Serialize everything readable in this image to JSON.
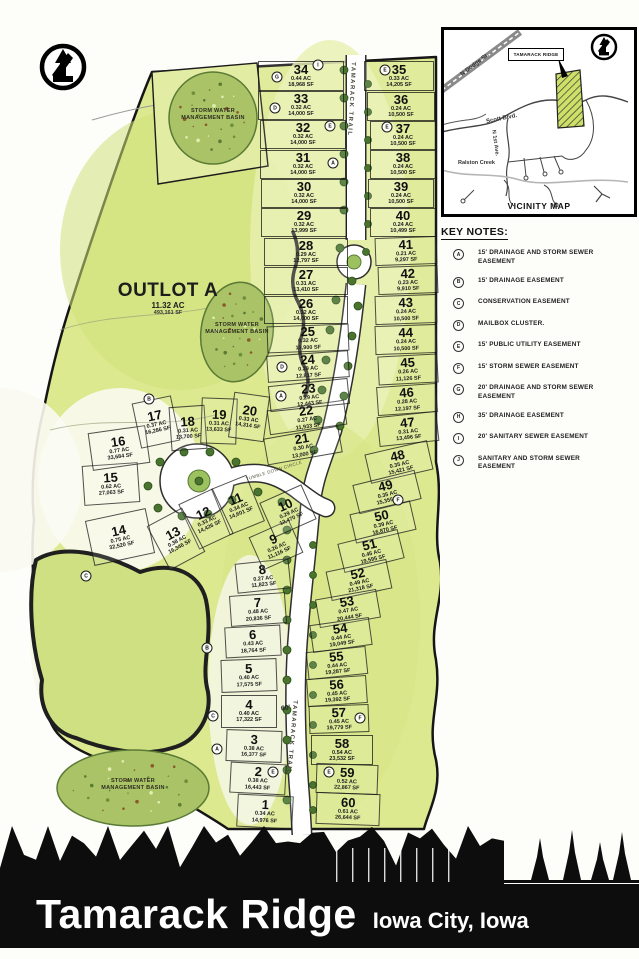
{
  "banner": {
    "title": "Tamarack Ridge",
    "subtitle": "Iowa City, Iowa"
  },
  "north_arrow": {
    "letter": "N"
  },
  "vicinity": {
    "caption": "VICINITY MAP",
    "site_label": "TAMARACK RIDGE",
    "roads": {
      "n_dodge": "N Dodge St.",
      "scott": "Scott Blvd.",
      "n_first": "N 1st Ave.",
      "creek": "Ralston Creek"
    }
  },
  "key_notes": {
    "title": "KEY NOTES:",
    "items": [
      {
        "key": "A",
        "text": "15' DRAINAGE AND STORM SEWER EASEMENT"
      },
      {
        "key": "B",
        "text": "15' DRAINAGE EASEMENT"
      },
      {
        "key": "C",
        "text": "CONSERVATION EASEMENT"
      },
      {
        "key": "D",
        "text": "MAILBOX CLUSTER."
      },
      {
        "key": "E",
        "text": "15' PUBLIC UTILITY EASEMENT"
      },
      {
        "key": "F",
        "text": "15' STORM SEWER EASEMENT"
      },
      {
        "key": "G",
        "text": "20' DRAINAGE AND STORM SEWER EASEMENT"
      },
      {
        "key": "H",
        "text": "35' DRAINAGE EASEMENT"
      },
      {
        "key": "I",
        "text": "20' SANITARY SEWER EASEMENT"
      },
      {
        "key": "J",
        "text": "SANITARY AND STORM SEWER EASEMENT"
      }
    ]
  },
  "plat": {
    "outlot": {
      "name": "OUTLOT A",
      "acres": "11.32 AC",
      "sqft": "493,161 SF"
    },
    "basin_label": "STORM WATER MANAGEMENT BASIN",
    "road_labels": {
      "trail": "TAMARACK TRAIL",
      "circle": "TUMBLE DOWN CIRCLE",
      "width": "60'"
    },
    "markers": [
      {
        "k": "I",
        "x": 318,
        "y": 65
      },
      {
        "k": "G",
        "x": 277,
        "y": 77
      },
      {
        "k": "D",
        "x": 275,
        "y": 108
      },
      {
        "k": "E",
        "x": 330,
        "y": 126
      },
      {
        "k": "E",
        "x": 385,
        "y": 70
      },
      {
        "k": "E",
        "x": 387,
        "y": 127
      },
      {
        "k": "A",
        "x": 333,
        "y": 163
      },
      {
        "k": "A",
        "x": 281,
        "y": 396
      },
      {
        "k": "D",
        "x": 282,
        "y": 367
      },
      {
        "k": "F",
        "x": 398,
        "y": 500
      },
      {
        "k": "F",
        "x": 360,
        "y": 718
      },
      {
        "k": "E",
        "x": 273,
        "y": 772
      },
      {
        "k": "E",
        "x": 329,
        "y": 772
      },
      {
        "k": "C",
        "x": 213,
        "y": 716
      },
      {
        "k": "A",
        "x": 217,
        "y": 749
      },
      {
        "k": "B",
        "x": 207,
        "y": 648
      },
      {
        "k": "C",
        "x": 86,
        "y": 576
      },
      {
        "k": "B",
        "x": 149,
        "y": 399
      }
    ],
    "lots": [
      {
        "n": "1",
        "ac": "0.34 AC",
        "sf": "14,976 SF",
        "x": 265,
        "y": 811,
        "w": 56,
        "h": 33,
        "r": 3
      },
      {
        "n": "2",
        "ac": "0.38 AC",
        "sf": "16,443 SF",
        "x": 258,
        "y": 778,
        "w": 56,
        "h": 31,
        "r": 3
      },
      {
        "n": "3",
        "ac": "0.38 AC",
        "sf": "16,377 SF",
        "x": 254,
        "y": 746,
        "w": 56,
        "h": 32,
        "r": 2
      },
      {
        "n": "4",
        "ac": "0.40 AC",
        "sf": "17,322 SF",
        "x": 249,
        "y": 711,
        "w": 56,
        "h": 33,
        "r": 0
      },
      {
        "n": "5",
        "ac": "0.40 AC",
        "sf": "17,575 SF",
        "x": 249,
        "y": 675,
        "w": 56,
        "h": 33,
        "r": -2
      },
      {
        "n": "6",
        "ac": "0.43 AC",
        "sf": "18,764 SF",
        "x": 253,
        "y": 641,
        "w": 56,
        "h": 31,
        "r": -3
      },
      {
        "n": "7",
        "ac": "0.48 AC",
        "sf": "20,836 SF",
        "x": 258,
        "y": 609,
        "w": 56,
        "h": 31,
        "r": -4
      },
      {
        "n": "8",
        "ac": "0.27 AC",
        "sf": "11,823 SF",
        "x": 263,
        "y": 576,
        "w": 54,
        "h": 30,
        "r": -6
      },
      {
        "n": "9",
        "ac": "0.26 AC",
        "sf": "11,116 SF",
        "x": 276,
        "y": 545,
        "w": 44,
        "h": 36,
        "r": -24
      },
      {
        "n": "10",
        "ac": "0.29 AC",
        "sf": "12,470 SF",
        "x": 288,
        "y": 511,
        "w": 46,
        "h": 38,
        "r": -24
      },
      {
        "n": "11",
        "ac": "0.34 AC",
        "sf": "14,601 SF",
        "x": 238,
        "y": 505,
        "w": 38,
        "h": 50,
        "r": -22
      },
      {
        "n": "12",
        "ac": "0.33 AC",
        "sf": "14,426 SF",
        "x": 206,
        "y": 519,
        "w": 38,
        "h": 50,
        "r": -25
      },
      {
        "n": "13",
        "ac": "0.38 AC",
        "sf": "16,346 SF",
        "x": 176,
        "y": 539,
        "w": 40,
        "h": 50,
        "r": -28
      },
      {
        "n": "14",
        "ac": "0.75 AC",
        "sf": "32,520 SF",
        "x": 120,
        "y": 537,
        "w": 62,
        "h": 46,
        "r": -12
      },
      {
        "n": "15",
        "ac": "0.62 AC",
        "sf": "27,063 SF",
        "x": 111,
        "y": 484,
        "w": 56,
        "h": 40,
        "r": -4
      },
      {
        "n": "16",
        "ac": "0.77 AC",
        "sf": "33,684 SF",
        "x": 119,
        "y": 448,
        "w": 58,
        "h": 38,
        "r": -8
      },
      {
        "n": "17",
        "ac": "0.37 AC",
        "sf": "16,286 SF",
        "x": 156,
        "y": 422,
        "w": 40,
        "h": 46,
        "r": -12
      },
      {
        "n": "18",
        "ac": "0.31 AC",
        "sf": "13,700 SF",
        "x": 188,
        "y": 428,
        "w": 36,
        "h": 44,
        "r": -4
      },
      {
        "n": "19",
        "ac": "0.31 AC",
        "sf": "13,633 SF",
        "x": 219,
        "y": 421,
        "w": 36,
        "h": 46,
        "r": 2
      },
      {
        "n": "20",
        "ac": "0.33 AC",
        "sf": "14,314 SF",
        "x": 249,
        "y": 417,
        "w": 36,
        "h": 46,
        "r": 8
      },
      {
        "n": "21",
        "ac": "0.30 AC",
        "sf": "13,000 SF",
        "x": 303,
        "y": 445,
        "w": 76,
        "h": 27,
        "r": -10
      },
      {
        "n": "22",
        "ac": "0.27 AC",
        "sf": "11,933 SF",
        "x": 307,
        "y": 417,
        "w": 78,
        "h": 25,
        "r": -8
      },
      {
        "n": "23",
        "ac": "0.29 AC",
        "sf": "12,443 SF",
        "x": 309,
        "y": 395,
        "w": 80,
        "h": 26,
        "r": -6
      },
      {
        "n": "24",
        "ac": "0.29 AC",
        "sf": "12,817 SF",
        "x": 308,
        "y": 366,
        "w": 82,
        "h": 27,
        "r": -4
      },
      {
        "n": "25",
        "ac": "0.32 AC",
        "sf": "13,900 SF",
        "x": 308,
        "y": 338,
        "w": 82,
        "h": 27,
        "r": -2
      },
      {
        "n": "26",
        "ac": "0.32 AC",
        "sf": "14,000 SF",
        "x": 306,
        "y": 310,
        "w": 84,
        "h": 28,
        "r": 0
      },
      {
        "n": "27",
        "ac": "0.31 AC",
        "sf": "13,410 SF",
        "x": 306,
        "y": 281,
        "w": 84,
        "h": 28,
        "r": 0
      },
      {
        "n": "28",
        "ac": "0.29 AC",
        "sf": "12,797 SF",
        "x": 306,
        "y": 252,
        "w": 84,
        "h": 28,
        "r": 0
      },
      {
        "n": "29",
        "ac": "0.32 AC",
        "sf": "13,999 SF",
        "x": 304,
        "y": 222,
        "w": 86,
        "h": 29,
        "r": 0
      },
      {
        "n": "30",
        "ac": "0.32 AC",
        "sf": "14,000 SF",
        "x": 304,
        "y": 193,
        "w": 86,
        "h": 29,
        "r": 0
      },
      {
        "n": "31",
        "ac": "0.32 AC",
        "sf": "14,000 SF",
        "x": 303,
        "y": 164,
        "w": 86,
        "h": 29,
        "r": 0
      },
      {
        "n": "32",
        "ac": "0.32 AC",
        "sf": "14,000 SF",
        "x": 303,
        "y": 134,
        "w": 86,
        "h": 29,
        "r": 0
      },
      {
        "n": "33",
        "ac": "0.32 AC",
        "sf": "14,000 SF",
        "x": 301,
        "y": 105,
        "w": 86,
        "h": 29,
        "r": 0
      },
      {
        "n": "34",
        "ac": "0.44 AC",
        "sf": "18,968 SF",
        "x": 301,
        "y": 76,
        "w": 86,
        "h": 30,
        "r": 0
      },
      {
        "n": "35",
        "ac": "0.33 AC",
        "sf": "14,205 SF",
        "x": 399,
        "y": 76,
        "w": 70,
        "h": 30,
        "r": 0
      },
      {
        "n": "36",
        "ac": "0.24 AC",
        "sf": "10,500 SF",
        "x": 401,
        "y": 106,
        "w": 68,
        "h": 29,
        "r": 0
      },
      {
        "n": "37",
        "ac": "0.24 AC",
        "sf": "10,500 SF",
        "x": 403,
        "y": 135,
        "w": 66,
        "h": 29,
        "r": 0
      },
      {
        "n": "38",
        "ac": "0.24 AC",
        "sf": "10,500 SF",
        "x": 403,
        "y": 164,
        "w": 66,
        "h": 29,
        "r": 0
      },
      {
        "n": "39",
        "ac": "0.24 AC",
        "sf": "10,500 SF",
        "x": 401,
        "y": 193,
        "w": 66,
        "h": 29,
        "r": 0
      },
      {
        "n": "40",
        "ac": "0.24 AC",
        "sf": "10,499 SF",
        "x": 403,
        "y": 222,
        "w": 66,
        "h": 29,
        "r": 0
      },
      {
        "n": "41",
        "ac": "0.21 AC",
        "sf": "9,297 SF",
        "x": 406,
        "y": 251,
        "w": 62,
        "h": 28,
        "r": -2
      },
      {
        "n": "42",
        "ac": "0.23 AC",
        "sf": "9,910 SF",
        "x": 408,
        "y": 280,
        "w": 60,
        "h": 28,
        "r": -2
      },
      {
        "n": "43",
        "ac": "0.24 AC",
        "sf": "10,500 SF",
        "x": 406,
        "y": 309,
        "w": 62,
        "h": 29,
        "r": -2
      },
      {
        "n": "44",
        "ac": "0.24 AC",
        "sf": "10,500 SF",
        "x": 406,
        "y": 339,
        "w": 62,
        "h": 29,
        "r": -2
      },
      {
        "n": "45",
        "ac": "0.26 AC",
        "sf": "11,126 SF",
        "x": 408,
        "y": 369,
        "w": 60,
        "h": 29,
        "r": -3
      },
      {
        "n": "46",
        "ac": "0.28 AC",
        "sf": "12,197 SF",
        "x": 407,
        "y": 399,
        "w": 60,
        "h": 29,
        "r": -4
      },
      {
        "n": "47",
        "ac": "0.31 AC",
        "sf": "13,496 SF",
        "x": 408,
        "y": 429,
        "w": 60,
        "h": 30,
        "r": -6
      },
      {
        "n": "48",
        "ac": "0.35 AC",
        "sf": "15,421 SF",
        "x": 399,
        "y": 462,
        "w": 64,
        "h": 30,
        "r": -13
      },
      {
        "n": "49",
        "ac": "0.35 AC",
        "sf": "15,355 SF",
        "x": 387,
        "y": 492,
        "w": 64,
        "h": 30,
        "r": -14
      },
      {
        "n": "50",
        "ac": "0.39 AC",
        "sf": "16,870 SF",
        "x": 383,
        "y": 522,
        "w": 62,
        "h": 30,
        "r": -13
      },
      {
        "n": "51",
        "ac": "0.45 AC",
        "sf": "19,595 SF",
        "x": 371,
        "y": 551,
        "w": 62,
        "h": 30,
        "r": -14
      },
      {
        "n": "52",
        "ac": "0.49 AC",
        "sf": "21,318 SF",
        "x": 359,
        "y": 580,
        "w": 62,
        "h": 30,
        "r": -12
      },
      {
        "n": "53",
        "ac": "0.47 AC",
        "sf": "20,444 SF",
        "x": 348,
        "y": 608,
        "w": 62,
        "h": 29,
        "r": -10
      },
      {
        "n": "54",
        "ac": "0.44 AC",
        "sf": "19,049 SF",
        "x": 341,
        "y": 635,
        "w": 60,
        "h": 28,
        "r": -8
      },
      {
        "n": "55",
        "ac": "0.44 AC",
        "sf": "19,287 SF",
        "x": 337,
        "y": 663,
        "w": 60,
        "h": 28,
        "r": -6
      },
      {
        "n": "56",
        "ac": "0.45 AC",
        "sf": "19,392 SF",
        "x": 337,
        "y": 691,
        "w": 60,
        "h": 28,
        "r": -4
      },
      {
        "n": "57",
        "ac": "0.45 AC",
        "sf": "19,779 SF",
        "x": 339,
        "y": 719,
        "w": 60,
        "h": 28,
        "r": -2
      },
      {
        "n": "58",
        "ac": "0.54 AC",
        "sf": "23,532 SF",
        "x": 342,
        "y": 750,
        "w": 62,
        "h": 30,
        "r": 0
      },
      {
        "n": "59",
        "ac": "0.52 AC",
        "sf": "22,867 SF",
        "x": 347,
        "y": 779,
        "w": 62,
        "h": 30,
        "r": 2
      },
      {
        "n": "60",
        "ac": "0.61 AC",
        "sf": "26,644 SF",
        "x": 348,
        "y": 809,
        "w": 64,
        "h": 32,
        "r": 2
      }
    ]
  }
}
